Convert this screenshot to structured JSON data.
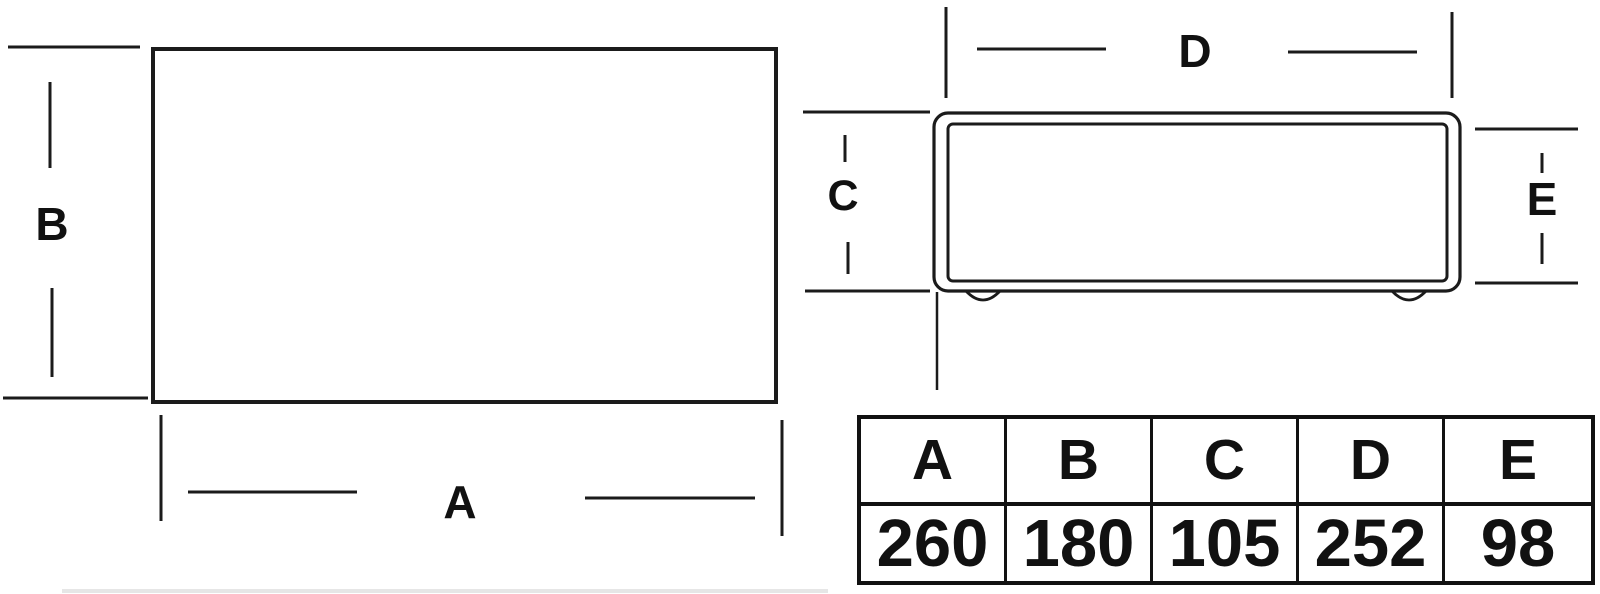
{
  "diagram": {
    "description": "Two-view technical dimension drawing of an enclosure with dimension table",
    "labels": {
      "a": "A",
      "b": "B",
      "c": "C",
      "d": "D",
      "e": "E"
    }
  },
  "table": {
    "headers": [
      "A",
      "B",
      "C",
      "D",
      "E"
    ],
    "values": [
      "260",
      "180",
      "105",
      "252",
      "98"
    ]
  },
  "colors": {
    "line": "#1b1b1b",
    "text": "#111111",
    "background": "#ffffff"
  }
}
